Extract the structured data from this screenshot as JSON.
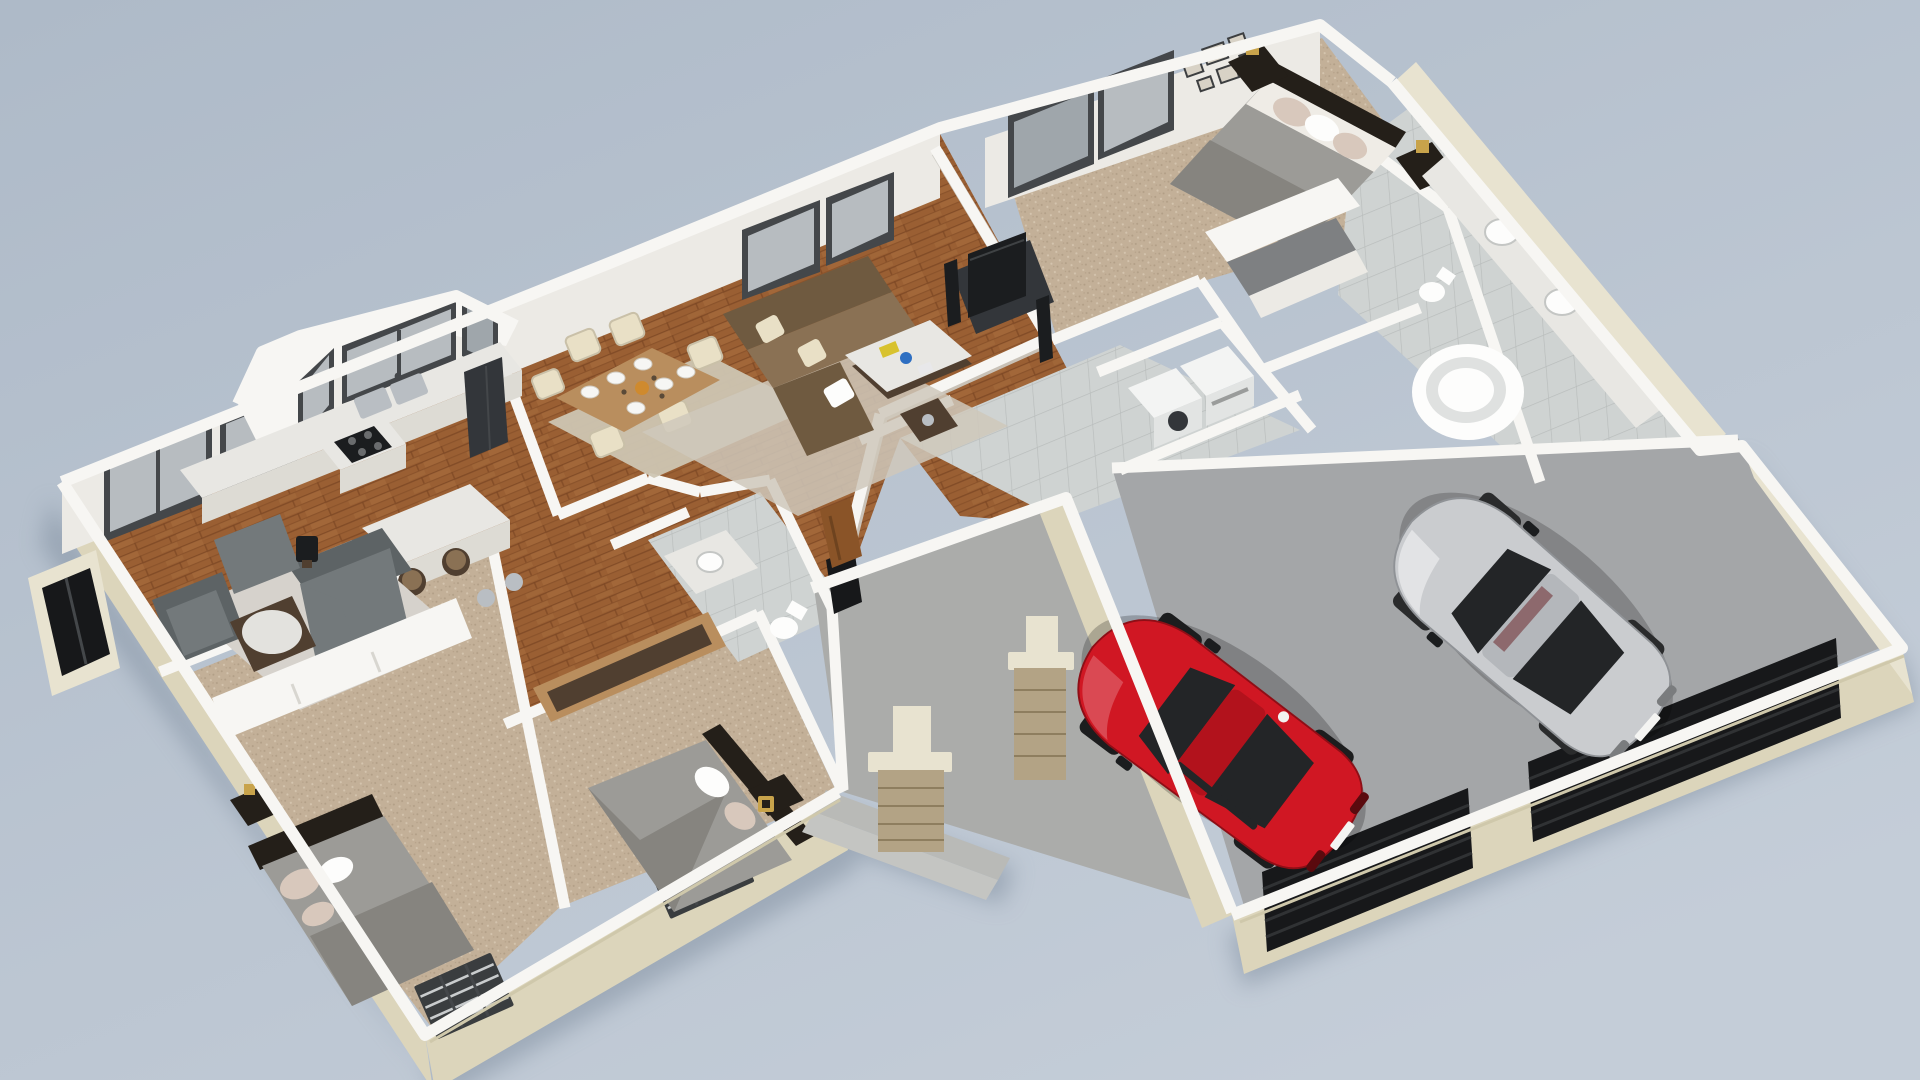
{
  "scene": {
    "title": "3D isometric floor plan rendering of a single-story house",
    "view": "isometric aerial cutaway (walls cut at waist height)",
    "style": "photoreal architectural visualization on plain blue-gray backdrop"
  },
  "rooms": [
    {
      "id": "kitchen",
      "label": "Kitchen",
      "floor": "hardwood",
      "features": [
        "bay window with double sink",
        "cooktop peninsula",
        "island with two bar stools",
        "refrigerator"
      ]
    },
    {
      "id": "dining-room",
      "label": "Dining Room",
      "floor": "hardwood",
      "features": [
        "wood table with six place settings",
        "six cream chairs",
        "patterned area rug"
      ]
    },
    {
      "id": "living-room",
      "label": "Living Room",
      "floor": "hardwood",
      "features": [
        "brown sectional sofa",
        "marble coffee table",
        "TV console with flat screen and speakers"
      ]
    },
    {
      "id": "family-room",
      "label": "Family Sitting Room",
      "floor": "hardwood",
      "features": [
        "gray sectional",
        "gray armchair",
        "ottoman",
        "round coffee table",
        "shag rug"
      ]
    },
    {
      "id": "master-bedroom",
      "label": "Master Bedroom",
      "floor": "carpet",
      "features": [
        "gray bed with pillows",
        "two nightstands with lamps",
        "mirrored sliding closet",
        "gallery picture wall"
      ]
    },
    {
      "id": "walk-in-closet",
      "label": "Walk-in Closet",
      "floor": "carpet",
      "features": [
        "white shelving"
      ]
    },
    {
      "id": "master-bathroom",
      "label": "Master Bathroom",
      "floor": "tile",
      "features": [
        "double vanity",
        "round soaking tub",
        "toilet",
        "two windows"
      ]
    },
    {
      "id": "laundry-room",
      "label": "Laundry Room",
      "floor": "tile",
      "features": [
        "washer",
        "dryer"
      ]
    },
    {
      "id": "hall-bathroom",
      "label": "Hall Bathroom",
      "floor": "tile",
      "features": [
        "vanity sink",
        "toilet"
      ]
    },
    {
      "id": "bedroom-2",
      "label": "Bedroom 2",
      "floor": "carpet",
      "features": [
        "gray bed",
        "sliding-door closet"
      ]
    },
    {
      "id": "bedroom-3",
      "label": "Bedroom 3",
      "floor": "carpet",
      "features": [
        "gray bed",
        "open wood closet",
        "nightstand with gold lamp"
      ]
    },
    {
      "id": "entry-porch",
      "label": "Entry Porch",
      "floor": "concrete",
      "features": [
        "two stone pillars",
        "front steps",
        "wood front door"
      ]
    },
    {
      "id": "garage",
      "label": "Two-Car Garage",
      "floor": "concrete",
      "features": [
        "two dark roller doors",
        "red coupe",
        "silver coupe"
      ]
    }
  ],
  "vehicles": [
    {
      "id": "red-car",
      "label": "Red sports coupe",
      "body_color": "#d01723",
      "roof_color": "#b2121c"
    },
    {
      "id": "silver-car",
      "label": "Silver sports coupe",
      "body_color": "#cacccf",
      "roof_color": "#b4b7bb"
    }
  ],
  "colors": {
    "background_top": "#aebac8",
    "background_bottom": "#c4cdd8",
    "shadow": "#7d8b9c",
    "wall_top": "#f7f6f3",
    "wall_face": "#eceae5",
    "wall_face_shade": "#dddbd4",
    "exterior_front": "#dcd5bb",
    "exterior_side": "#e8e3d0",
    "exterior_edge": "#cfc8ab",
    "wood_base": "#9a5f33",
    "wood_dark": "#7c4724",
    "wood_light": "#b07544",
    "carpet_base": "#c3b098",
    "carpet_dot": "#b19e86",
    "carpet_light": "#d4c4ae",
    "tile_base": "#cfd3d2",
    "tile_line": "#b9bdbc",
    "garage_floor": "#a4a6a8",
    "porch_floor": "#abacaa",
    "porch_step": "#b9bab7",
    "rug_light": "#d6d2cc",
    "rug_dining": "#cdc5b2",
    "rug_living": "#cfc8bb",
    "sofa_brown": "#8a7154",
    "sofa_brown_dark": "#6f5a40",
    "pillow_cream": "#e9e0c6",
    "sofa_gray": "#73797b",
    "sofa_gray_dark": "#5d6365",
    "table_wood": "#b98e5e",
    "table_dark": "#503f30",
    "marble": "#e8e7e3",
    "tv_black": "#1b1d1f",
    "bed_duvet": "#9c9b97",
    "bed_duvet_dark": "#86847f",
    "pillow_blush": "#d8c8bc",
    "headboard": "#241f19",
    "gold": "#c8a34b",
    "appliance_white": "#f3f4f3",
    "appliance_dark": "#33363a",
    "steel": "#b9bec3",
    "window_glass": "#b7bcc0",
    "window_glass_dark": "#9fa6ab",
    "window_frame": "#44474a",
    "grille_dark": "#3a3d3f",
    "grille_slat": "#c9cccd",
    "door_black": "#17181a",
    "stone": "#b3a385",
    "stone_dark": "#8e7e5f",
    "car_glass": "#232527",
    "car_plate": "#f4f4f2",
    "entry_door_wood": "#8a5428"
  }
}
